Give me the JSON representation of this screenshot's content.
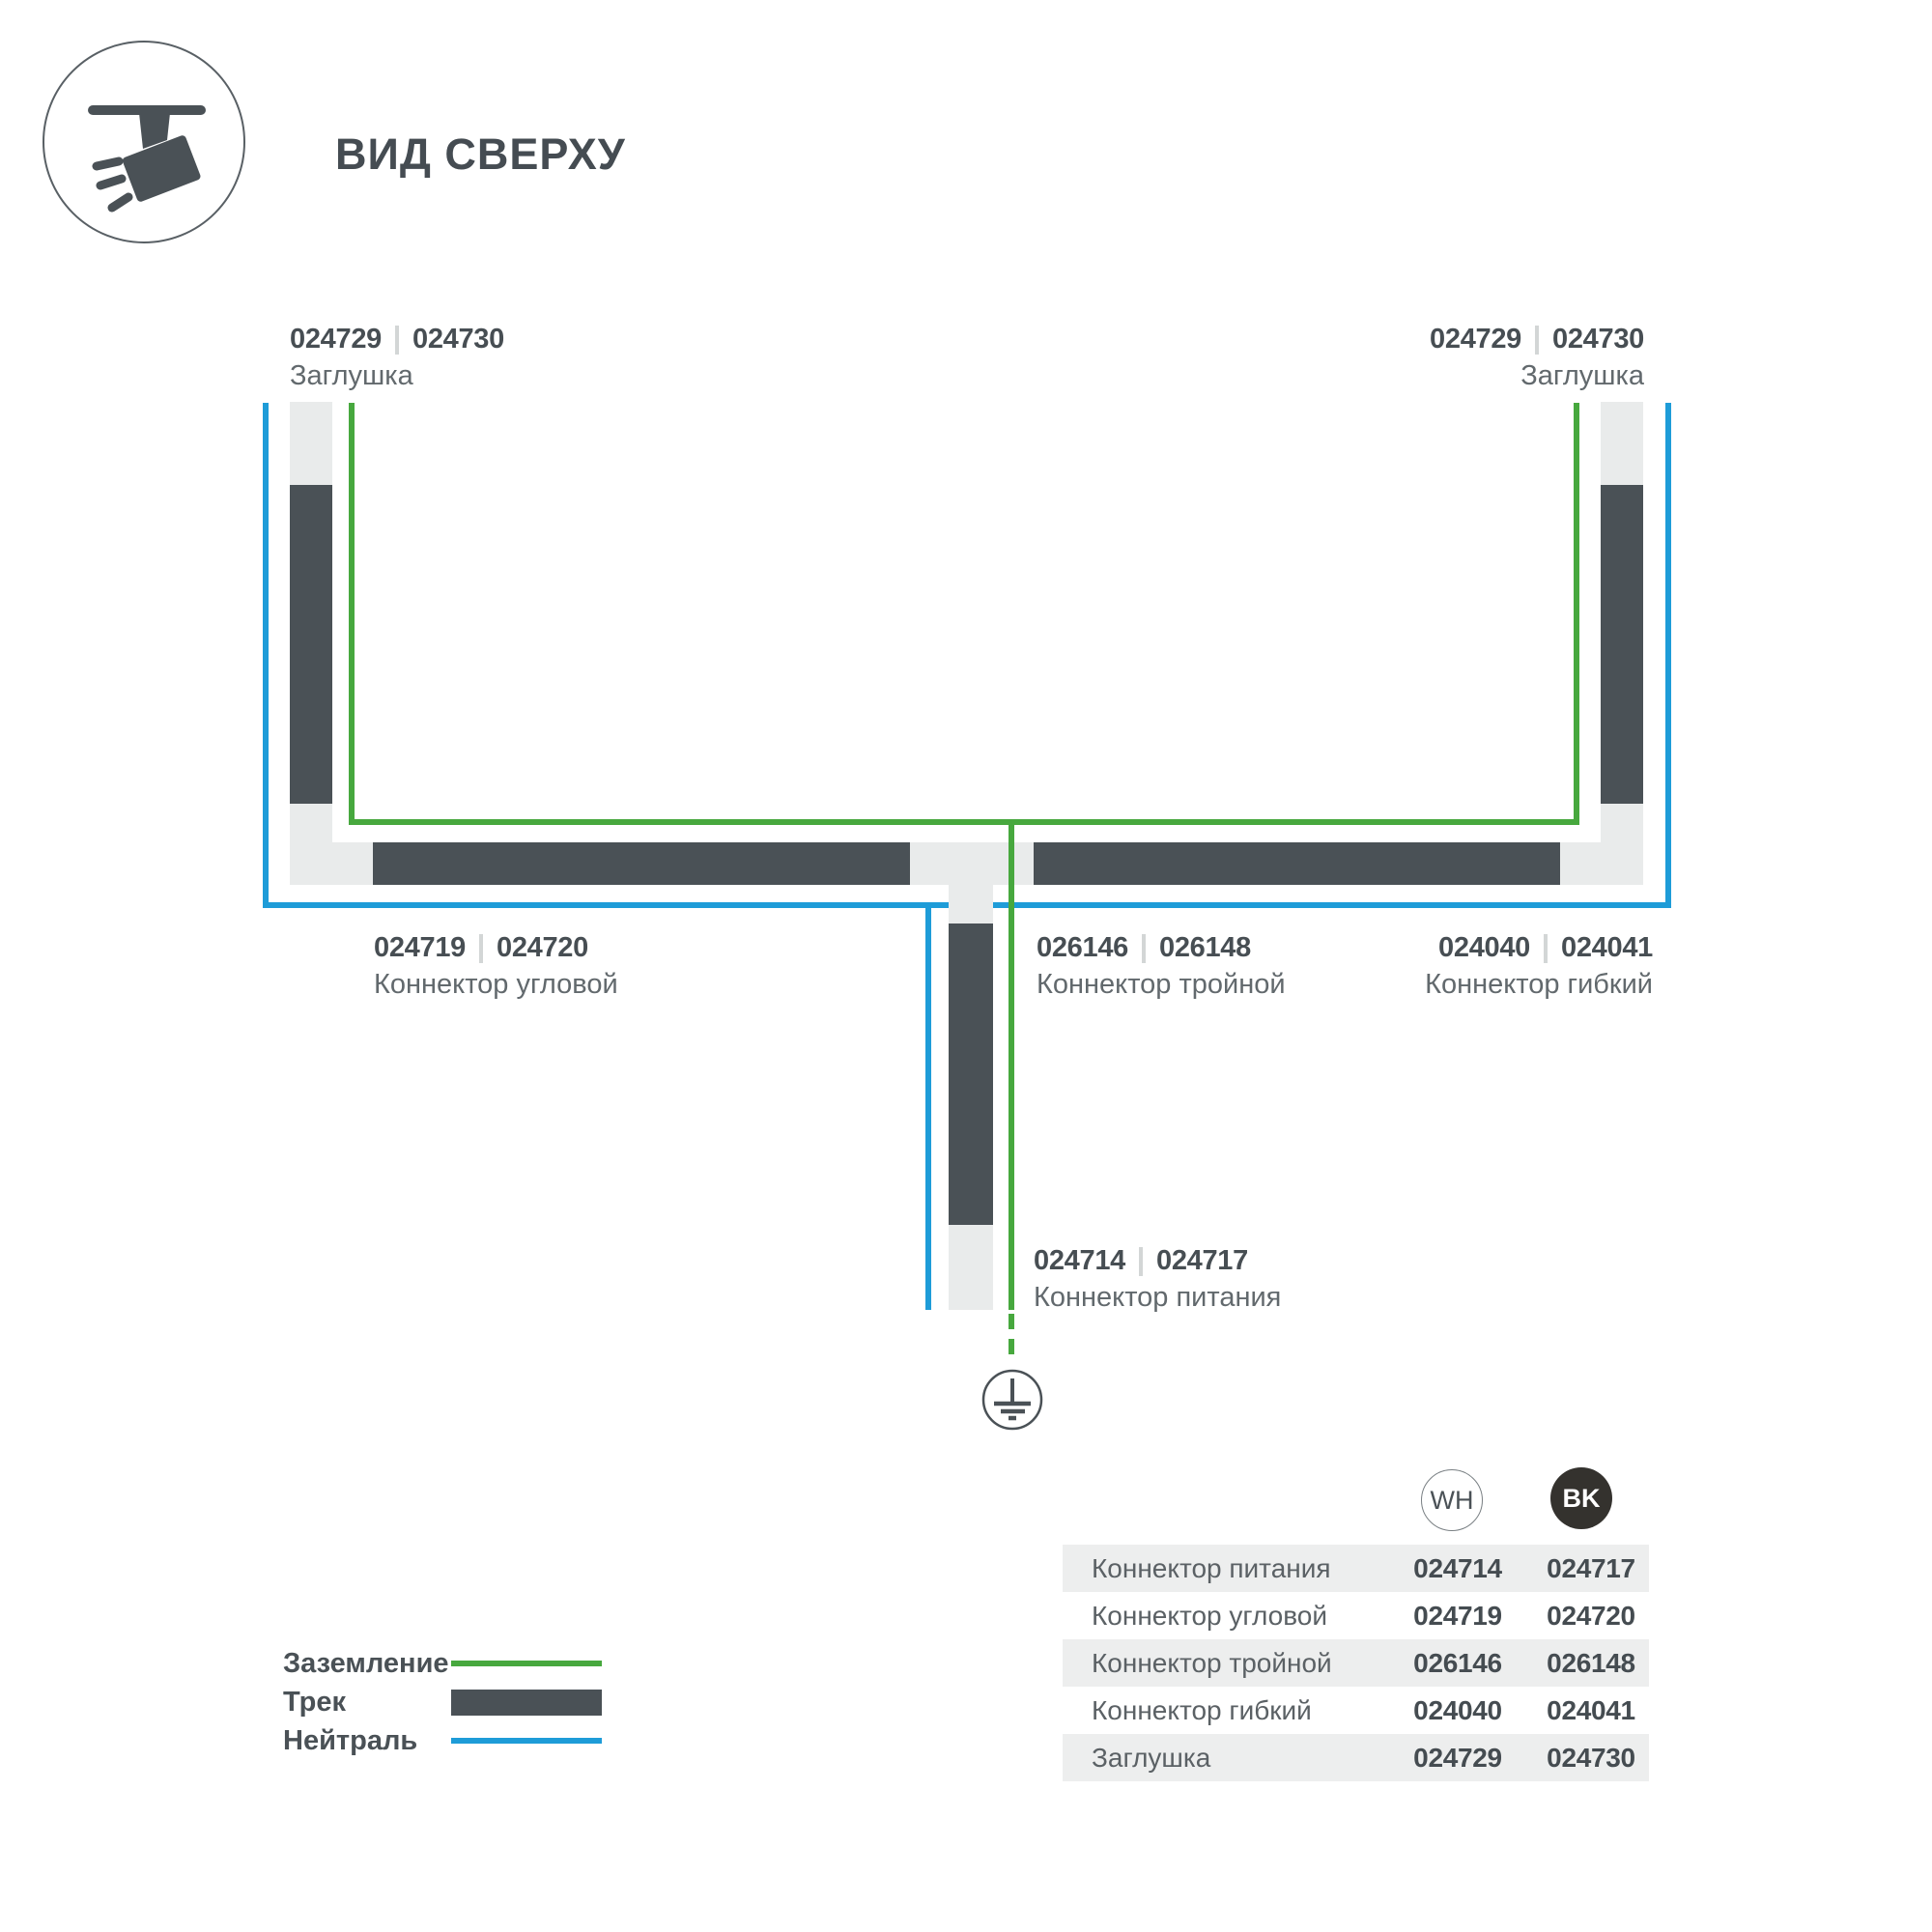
{
  "header": {
    "title": "ВИД СВЕРХУ"
  },
  "diagram": {
    "labels": {
      "endcap_left": {
        "codes": [
          "024729",
          "024730"
        ],
        "name": "Заглушка"
      },
      "endcap_right": {
        "codes": [
          "024729",
          "024730"
        ],
        "name": "Заглушка"
      },
      "corner": {
        "codes": [
          "024719",
          "024720"
        ],
        "name": "Коннектор угловой"
      },
      "triple": {
        "codes": [
          "026146",
          "026148"
        ],
        "name": "Коннектор тройной"
      },
      "flex": {
        "codes": [
          "024040",
          "024041"
        ],
        "name": "Коннектор гибкий"
      },
      "power": {
        "codes": [
          "024714",
          "024717"
        ],
        "name": "Коннектор питания"
      }
    },
    "colors": {
      "ground_green": "#47A83E",
      "neutral_blue": "#1E9CD8",
      "track_dark": "#4A5156",
      "connector_light": "#E9EBEB",
      "table_row_alt": "#EDEEEE",
      "bk_badge": "#34322E"
    }
  },
  "legend": {
    "items": [
      {
        "label": "Заземление",
        "type": "ground"
      },
      {
        "label": "Трек",
        "type": "track"
      },
      {
        "label": "Нейтраль",
        "type": "neutral"
      }
    ]
  },
  "table": {
    "columns": [
      {
        "id": "wh",
        "label": "WH"
      },
      {
        "id": "bk",
        "label": "BK"
      }
    ],
    "rows": [
      {
        "label": "Коннектор питания",
        "wh": "024714",
        "bk": "024717"
      },
      {
        "label": "Коннектор угловой",
        "wh": "024719",
        "bk": "024720"
      },
      {
        "label": "Коннектор тройной",
        "wh": "026146",
        "bk": "026148"
      },
      {
        "label": "Коннектор гибкий",
        "wh": "024040",
        "bk": "024041"
      },
      {
        "label": "Заглушка",
        "wh": "024729",
        "bk": "024730"
      }
    ]
  }
}
